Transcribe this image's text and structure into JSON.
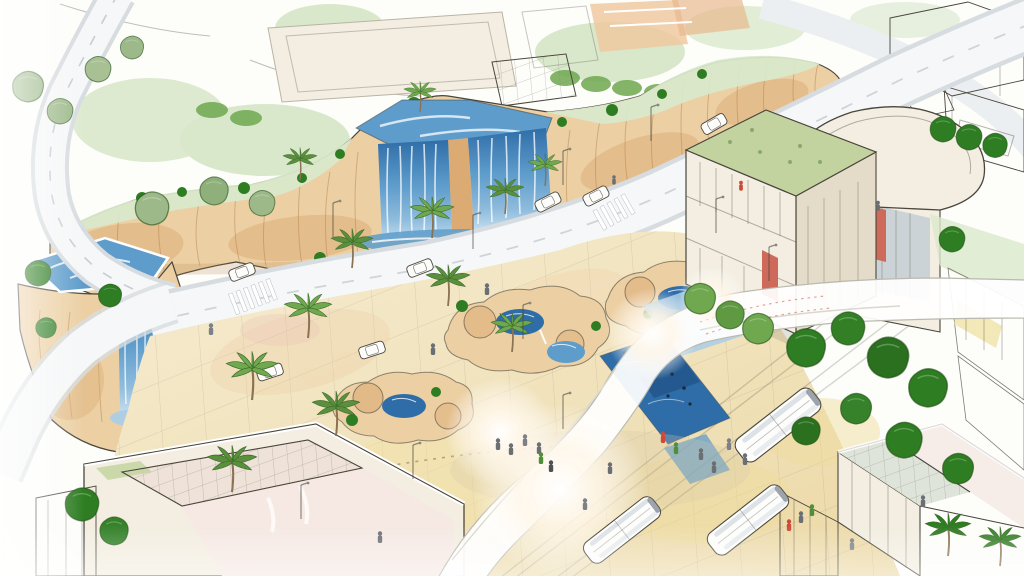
{
  "scene": {
    "type": "architectural-concept-sketch",
    "description": "Hand-drawn watercolor aerial rendering of an urban plaza: cliff-top park with sports courts and pools, twin waterfalls spilling down a sandstone cliff beside a curving avenue, rock-garden ponds and palm trees on a sandy paved plaza, a sinuous white pedestrian bridge with sun flare, tram buses, tiny pedestrians, and modern green-roofed buildings",
    "elements": [
      "cliff-terrace",
      "main-waterfall",
      "left-pool-waterfall",
      "curved-road",
      "avenue",
      "sports-courts",
      "swimming-pools",
      "plaza",
      "rock-gardens",
      "canal",
      "pedestrian-bridge",
      "tram-buses",
      "cars",
      "palm-trees",
      "round-trees",
      "people",
      "right-buildings",
      "top-right-buildings",
      "pyramid-building",
      "bottom-right-building",
      "street-lamps"
    ]
  },
  "colors": {
    "paper": "#fdfdfa",
    "ink": "#4a463c",
    "rock_light": "#ecd0a4",
    "rock_mid": "#dcab74",
    "rock_dark": "#b8834e",
    "water_light": "#a9cde8",
    "water_mid": "#5d9ccb",
    "water_deep": "#2f6da8",
    "water_dark": "#1e4c80",
    "foliage_dark": "#2e7d22",
    "foliage_mid": "#6fa84f",
    "foliage_sage": "#9db98a",
    "foliage_wash": "#d9e8cb",
    "sand_light": "#f6ecd0",
    "sand_mid": "#ecd9a4",
    "peach": "#efc9a0",
    "road": "#f6f7f8",
    "road_edge": "#d7dce0",
    "building": "#f3eee1",
    "building_shadow": "#e4dcc8",
    "glass": "#c2ccd3",
    "roof_green": "#c2d3a0",
    "accent_red": "#cd6a5a",
    "people_gray": "#6b6f74",
    "white": "#ffffff"
  }
}
